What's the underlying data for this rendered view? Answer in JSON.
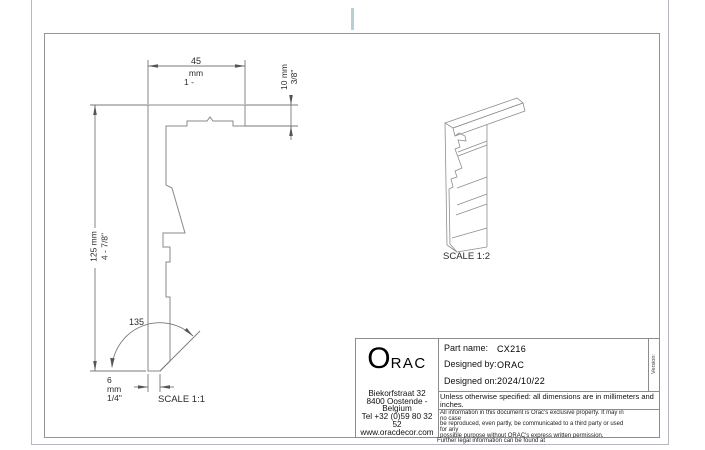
{
  "page": {
    "fold_mark_color": "#b9ced2",
    "line_color": "#8a8a8a"
  },
  "front_view": {
    "dim_width": {
      "value": "45",
      "unit": "mm",
      "inches": "1 -"
    },
    "dim_thickness": {
      "text": "10 mm\n3/8\""
    },
    "dim_height": {
      "text": "125 mm\n4 - 7/8\""
    },
    "dim_bottom": {
      "text": "6\nmm\n 1/4\""
    },
    "angle": "135",
    "scale_label": "SCALE 1:1"
  },
  "iso_view": {
    "scale_label": "SCALE 1:2"
  },
  "title_block": {
    "logo_o": "O",
    "logo_rac": "RAC",
    "address_lines": [
      "Biekorfstraat 32",
      "8400 Oostende -",
      "Belgium",
      "Tel  +32 (0)59 80 32",
      "52",
      "www.oracdecor.com"
    ],
    "part_name_label": "Part name:",
    "part_name": "CX216",
    "designed_by_label": "Designed by:",
    "designed_by": "ORAC",
    "designed_on_label": "Designed on:",
    "designed_on": "2024/10/22",
    "version_label": "Version:",
    "units_note": "Unless otherwise specified: all dimensions are in millimeters and inches.",
    "legal_lines": [
      "All information in this document is Orac's exclusive property.  It may in",
      "no case",
      "be reproduced, even partly, be communicated to a third party or used",
      "for any",
      "possible purpose without ORAC's express written permission."
    ],
    "legal_more": "Further legal information can be found at"
  }
}
